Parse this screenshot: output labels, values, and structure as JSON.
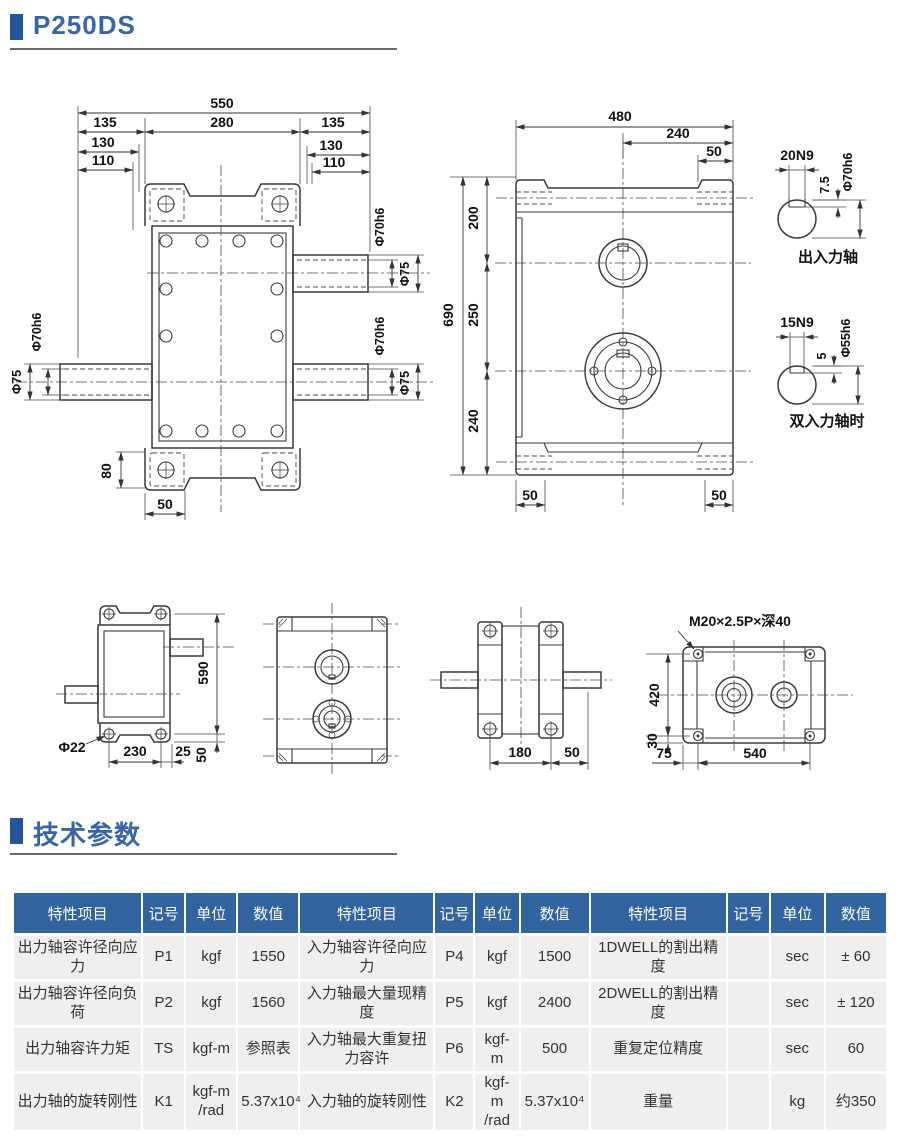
{
  "page": {
    "title": "P250DS",
    "section2": "技术参数"
  },
  "d1": {
    "n550": "550",
    "n280": "280",
    "n135": "135",
    "n130": "130",
    "n110": "110",
    "n80": "80",
    "n50": "50",
    "phi70": "Φ70h6",
    "phi75": "Φ75"
  },
  "d2": {
    "n480": "480",
    "n240t": "240",
    "n50": "50",
    "n690": "690",
    "n200": "200",
    "n250": "250",
    "n240b": "240"
  },
  "s1": {
    "key": "20N9",
    "depth": "7.5",
    "dia": "Φ70h6",
    "caption": "出入力轴"
  },
  "s2": {
    "key": "15N9",
    "depth": "5",
    "dia": "Φ55h6",
    "caption": "双入力轴时"
  },
  "v1": {
    "n590": "590",
    "phi22": "Φ22",
    "n230": "230",
    "n25": "25",
    "n50": "50"
  },
  "v3": {
    "n180": "180",
    "n50": "50"
  },
  "v4": {
    "thread": "M20×2.5P×深40",
    "n420": "420",
    "n30": "30",
    "n75": "75",
    "n540": "540"
  },
  "table": {
    "headers": [
      "特性项目",
      "记号",
      "单位",
      "数值",
      "特性项目",
      "记号",
      "单位",
      "数值",
      "特性项目",
      "记号",
      "单位",
      "数值"
    ],
    "rows": [
      [
        "出力轴容许径向应力",
        "P1",
        "kgf",
        "1550",
        "入力轴容许径向应力",
        "P4",
        "kgf",
        "1500",
        "1DWELL的割出精度",
        "",
        "sec",
        "± 60"
      ],
      [
        "出力轴容许径向负荷",
        "P2",
        "kgf",
        "1560",
        "入力轴最大量现精度",
        "P5",
        "kgf",
        "2400",
        "2DWELL的割出精度",
        "",
        "sec",
        "± 120"
      ],
      [
        "出力轴容许力矩",
        "TS",
        "kgf-m",
        "参照表",
        "入力轴最大重复扭力容许",
        "P6",
        "kgf-m",
        "500",
        "重复定位精度",
        "",
        "sec",
        "60"
      ],
      [
        "出力轴的旋转刚性",
        "K1",
        "kgf-m\n/rad",
        "5.37x10⁴",
        "入力轴的旋转刚性",
        "K2",
        "kgf-m\n/rad",
        "5.37x10⁴",
        "重量",
        "",
        "kg",
        "约350"
      ]
    ]
  }
}
